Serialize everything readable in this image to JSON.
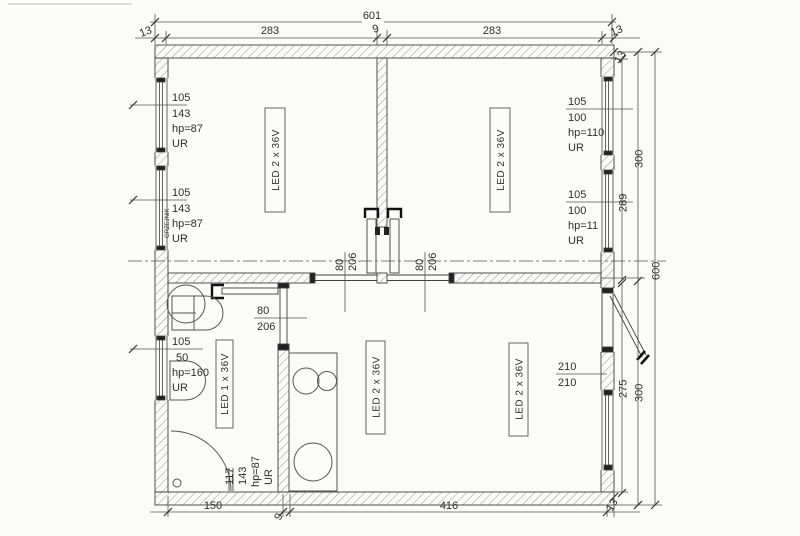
{
  "dims": {
    "total_width": "601",
    "top_segments": [
      "13",
      "283",
      "9",
      "283",
      "13"
    ],
    "right": {
      "inner_upper": "289",
      "upper": "300",
      "total": "600",
      "inner_lower": "275",
      "lower": "300",
      "wall_top": "13",
      "wall_bottom": "13"
    },
    "bottom": {
      "left": "150",
      "wall": "9",
      "right": "416",
      "corner": "13"
    }
  },
  "windows": {
    "left_top": [
      "105",
      "143",
      "hp=87",
      "UR"
    ],
    "left_mid": [
      "105",
      "143",
      "hp=87",
      "UR"
    ],
    "left_mid_note": "GRZEJNIK",
    "left_bottom": [
      "105",
      "50",
      "hp=160",
      "UR"
    ],
    "right_top": [
      "105",
      "100",
      "hp=110",
      "UR"
    ],
    "right_mid": [
      "105",
      "100",
      "hp=11",
      "UR"
    ],
    "bottom_left": [
      "117",
      "143",
      "hp=87",
      "UR"
    ]
  },
  "doors": {
    "room_top_left": [
      "80",
      "206"
    ],
    "room_top_right": [
      "80",
      "206"
    ],
    "bathroom": [
      "80",
      "206"
    ],
    "entrance": [
      "210",
      "210"
    ]
  },
  "lights": {
    "room_top_left": "LED 2 x 36V",
    "room_top_right": "LED 2 x 36V",
    "room_bottom_a": "LED 2 x 36V",
    "room_bottom_b": "LED 2 x 36V",
    "bathroom": "LED 1 x 36V"
  },
  "colors": {
    "line": "#3a3a3a",
    "paper": "#fbfbf9",
    "hatch": "#8a8a8a"
  }
}
